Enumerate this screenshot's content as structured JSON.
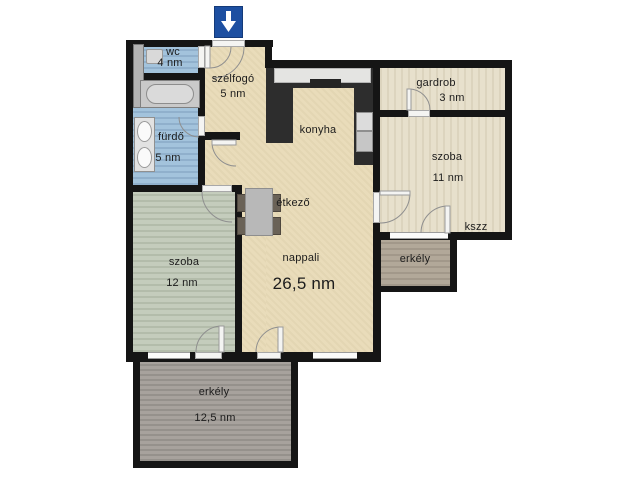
{
  "entrance": {
    "marker": "entrance-arrow-down"
  },
  "rooms": {
    "wc": {
      "name": "wc",
      "area": "4 nm"
    },
    "szelfogo": {
      "name": "szélfogó",
      "area": "5 nm"
    },
    "furdo": {
      "name": "fürdő",
      "area": "5 nm"
    },
    "konyha": {
      "name": "konyha"
    },
    "gardrob": {
      "name": "gardrob",
      "area": "3 nm"
    },
    "szoba11": {
      "name": "szoba",
      "area": "11 nm"
    },
    "kszz": {
      "name": "kszz"
    },
    "erkely_right": {
      "name": "erkély"
    },
    "etkezo": {
      "name": "étkező"
    },
    "nappali": {
      "name": "nappali",
      "area": "26,5 nm"
    },
    "szoba12": {
      "name": "szoba",
      "area": "12 nm"
    },
    "erkely_bottom": {
      "name": "erkély",
      "area": "12,5 nm"
    }
  },
  "colors": {
    "wall": "#151515",
    "floor_main": "#e9dcba",
    "floor_rooms_right": "#e7e0cc",
    "floor_wet": "#a3c3dc",
    "floor_room_green": "#c4ccbc",
    "balcony_right": "#b2a899",
    "balcony_bottom": "#a7a29d",
    "entrance_arrow": "#1d4fa1",
    "counter": "#2d2d2d"
  }
}
